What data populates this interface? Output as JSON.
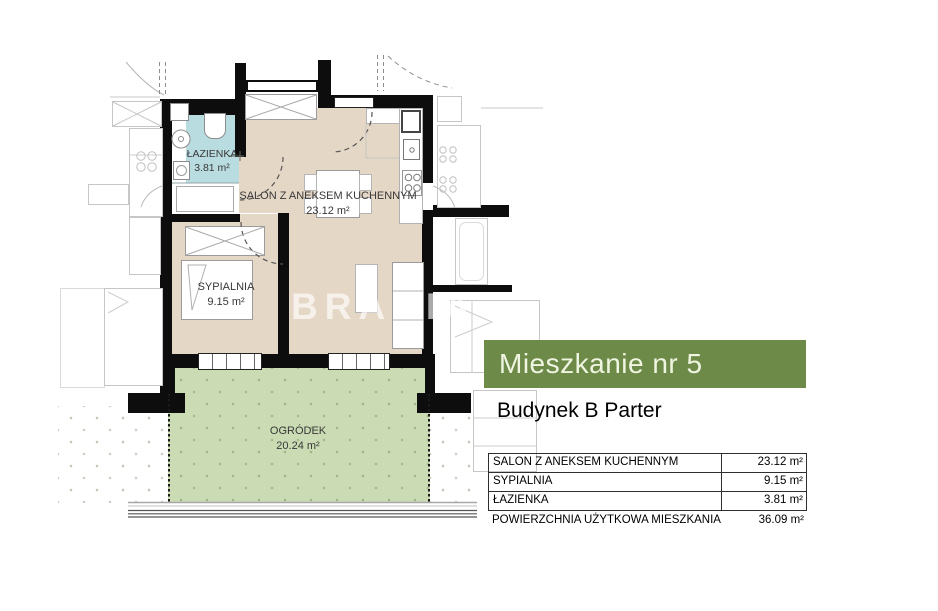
{
  "plan": {
    "watermark": "BRACIA",
    "rooms": [
      {
        "name": "ŁAZIENKA",
        "area": "3.81 m²"
      },
      {
        "name": "SALON Z ANEKSEM KUCHENNYM",
        "area": "23.12 m²"
      },
      {
        "name": "SYPIALNIA",
        "area": "9.15 m²"
      },
      {
        "name": "OGRÓDEK",
        "area": "20.24 m²"
      }
    ],
    "colors": {
      "wall": "#0d0d0d",
      "floor": "#e5d7c5",
      "bathroom": "#b9dce1",
      "garden": "#cbdcb4"
    }
  },
  "panel": {
    "title": "Mieszkanie nr 5",
    "subtitle": "Budynek B Parter",
    "accent_color": "#6e8a49",
    "table": {
      "rows": [
        {
          "label": "SALON Z ANEKSEM KUCHENNYM",
          "value": "23.12 m²"
        },
        {
          "label": "SYPIALNIA",
          "value": "9.15 m²"
        },
        {
          "label": "ŁAZIENKA",
          "value": "3.81 m²"
        },
        {
          "label": "POWIERZCHNIA UŻYTKOWA MIESZKANIA",
          "value": "36.09 m²"
        }
      ]
    }
  }
}
